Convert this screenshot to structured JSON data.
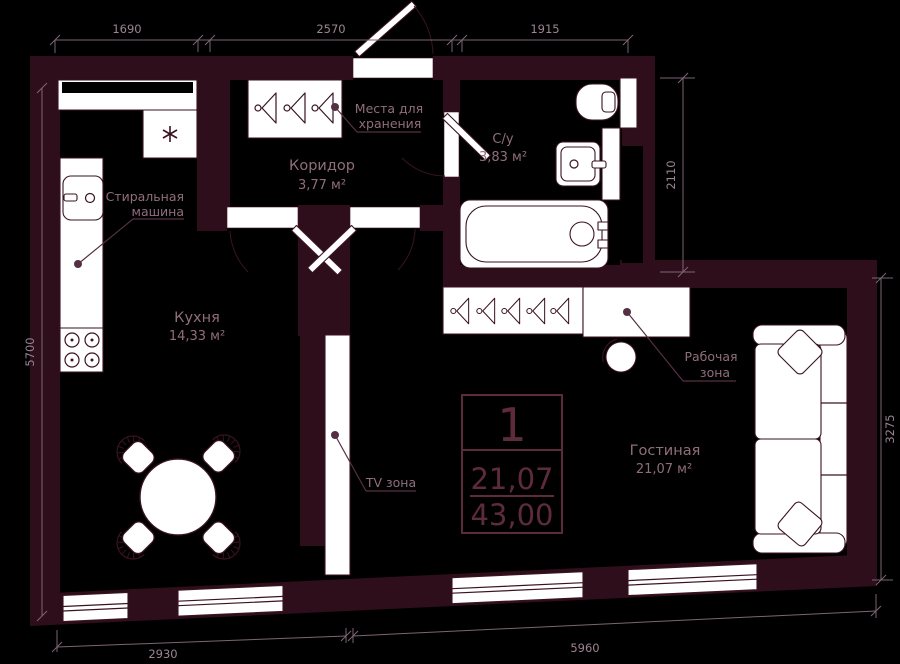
{
  "title": "Floor plan of one-room apartment",
  "rooms": {
    "kitchen": {
      "name": "Кухня",
      "area": "14,33 м²"
    },
    "corridor": {
      "name": "Коридор",
      "area": "3,77 м²"
    },
    "bathroom": {
      "name": "С/у",
      "area": "3,83 м²"
    },
    "living": {
      "name": "Гостиная",
      "area": "21,07 м²"
    }
  },
  "callouts": {
    "washer": {
      "line1": "Стиральная",
      "line2": "машина"
    },
    "storage": {
      "line1": "Места для",
      "line2": "хранения"
    },
    "work": {
      "line1": "Рабочая",
      "line2": "зона"
    },
    "tv": {
      "label": "TV зона"
    }
  },
  "dimensions": {
    "top": [
      "1690",
      "2570",
      "1915"
    ],
    "left": "5700",
    "right_upper": "2110",
    "right_lower": "3275",
    "bottom_left": "2930",
    "bottom_right": "5960"
  },
  "info_box": {
    "plan_number": "1",
    "area_living": "21,07",
    "area_total": "43,00"
  },
  "colors": {
    "background": "#000000",
    "wall": "#2f0e1c",
    "outline": "#3a1322",
    "white": "#ffffff",
    "dim_line": "#7d6573",
    "dim_text": "#9c8492",
    "label_text": "#8f6e7b",
    "leader": "#553043",
    "info": "#5d2b3d"
  }
}
